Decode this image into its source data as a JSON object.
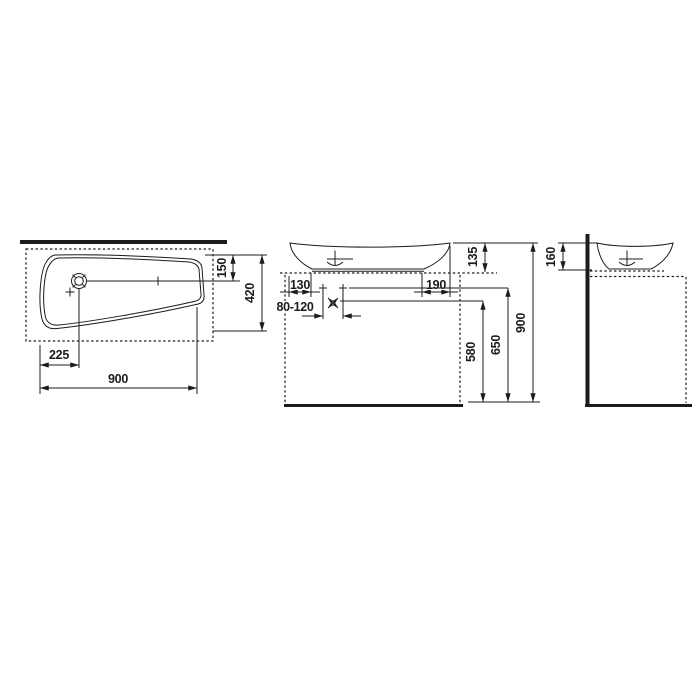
{
  "colors": {
    "ink": "#1c1c1c",
    "background": "#ffffff"
  },
  "plan_view": {
    "dim_drain_from_front": "150",
    "dim_depth": "420",
    "dim_drain_from_left": "225",
    "dim_width": "900"
  },
  "front_view": {
    "dim_left_overhang": "130",
    "dim_right_overhang": "190",
    "dim_tap_range": "80-120",
    "dim_bowl_above_counter": "135",
    "dim_outlet_height": "580",
    "dim_tap_height": "650",
    "dim_total_height": "900"
  },
  "side_view": {
    "dim_bowl_height": "160"
  }
}
